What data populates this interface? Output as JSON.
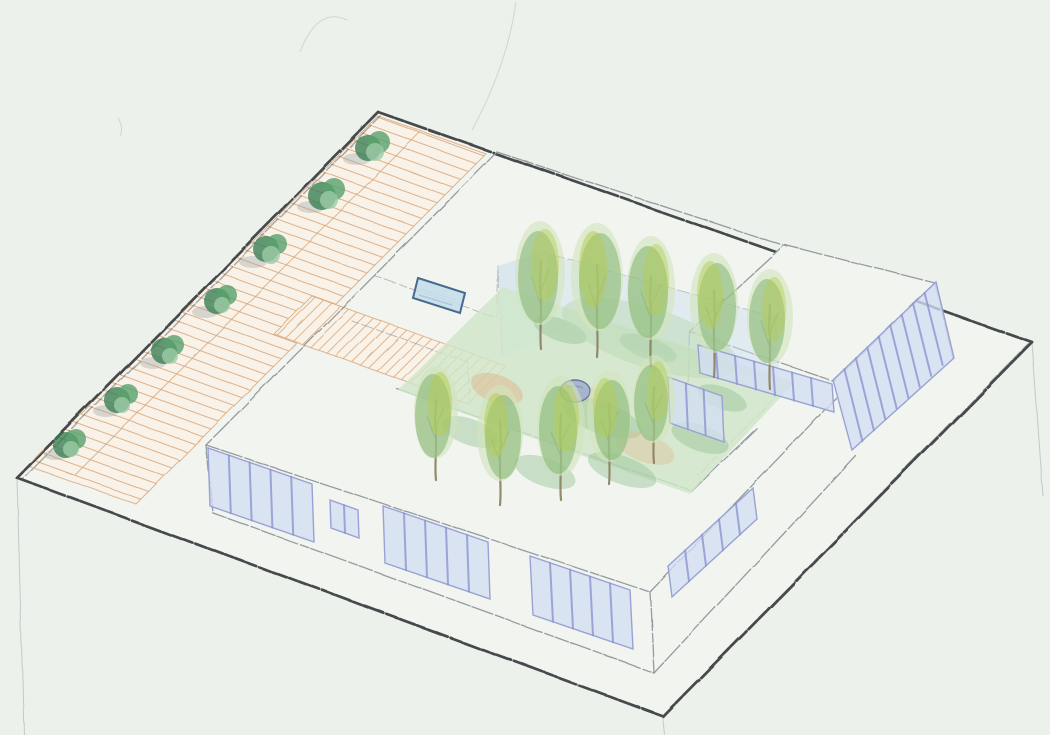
{
  "document": {
    "type": "hand-drawn architectural axonometric sketch",
    "medium": "graphite and colored pencil on paper",
    "subject": "Axonometric sketch of a single-storey courtyard building on a plinth with glazed facade bands, a roof pool, an inner tree garden with pond, and an L-shaped hatched entry path lined with bushes",
    "text_content": "none"
  },
  "palette": {
    "paper": "#edf1ec",
    "plinth": "#f1f4ef",
    "charcoal": "#45494c",
    "pencil": "#8f969b",
    "faint": "#bcc2c4",
    "path-fill": "#f8f2e8",
    "path-line": "#d9a679",
    "tan": "#dcb astray",
    "tan-wash": "#dcb58d",
    "bush-dark": "#2f7a4c",
    "bush-mid": "#58a06c",
    "bush-light": "#9ccaa6",
    "shadow": "#9aa0a0",
    "grass": "#cfe6c8",
    "grass-dark": "#8fbf8f",
    "grass-pale": "#bcd9b4",
    "trunk": "#8a8060",
    "leaf-green": "#79b06a",
    "leaf-yellow": "#b4cc52",
    "leaf-pale": "#d2e4bb",
    "pond": "#a3b0cd",
    "pond-edge": "#68799f",
    "glass": "#d3def2",
    "mullion": "#8b93d0",
    "frame": "#99a2d2",
    "wall-wash": "#d2e1f0",
    "pool-fill": "#c3dcea",
    "pool-edge": "#47698c"
  },
  "elements": {
    "site_plinth": 1,
    "hatched_paths": 2,
    "street_bushes": 7,
    "courtyard_trees": 10,
    "window_bands": 8,
    "roof_pool": 1,
    "garden_pond": 1,
    "courtyard_wall_washes": 3
  }
}
